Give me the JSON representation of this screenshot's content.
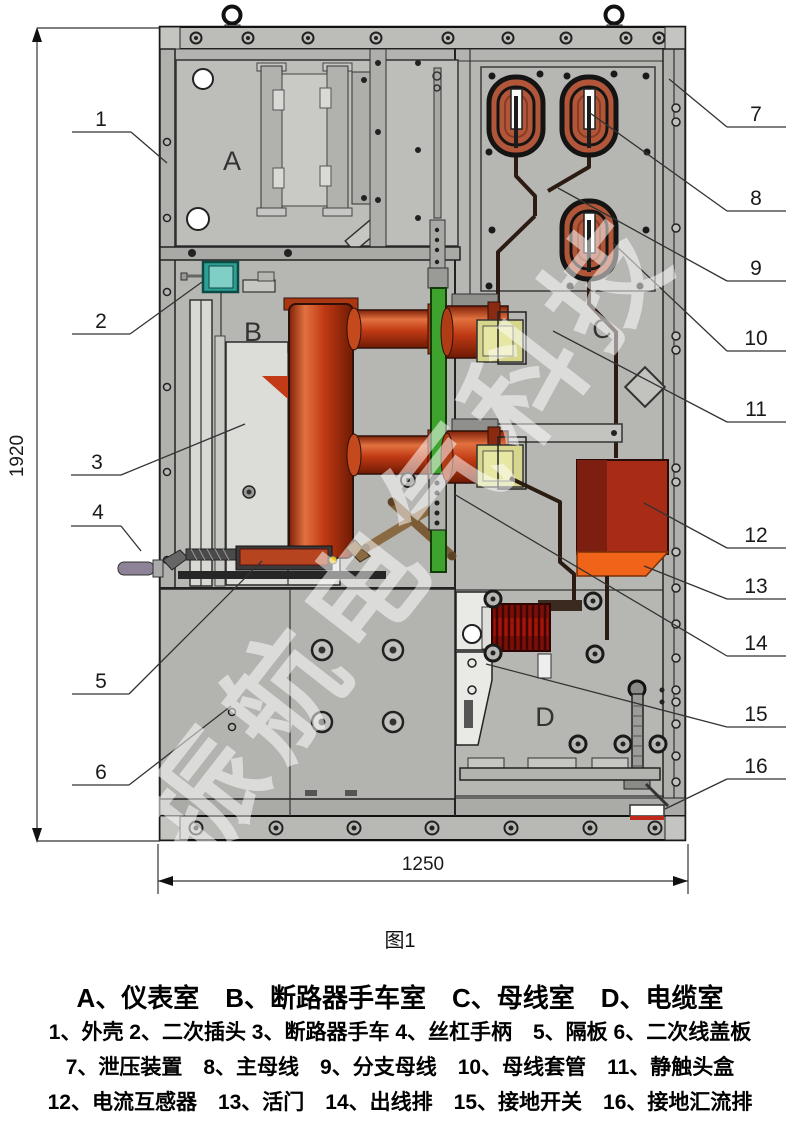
{
  "figure": {
    "caption": "图1",
    "height_dim": "1920",
    "width_dim": "1250"
  },
  "compartment_letters": {
    "a": "A",
    "b": "B",
    "c": "C",
    "d": "D"
  },
  "callouts": {
    "left": [
      {
        "n": "1"
      },
      {
        "n": "2"
      },
      {
        "n": "3"
      },
      {
        "n": "4"
      },
      {
        "n": "5"
      },
      {
        "n": "6"
      }
    ],
    "right": [
      {
        "n": "7"
      },
      {
        "n": "8"
      },
      {
        "n": "9"
      },
      {
        "n": "10"
      },
      {
        "n": "11"
      },
      {
        "n": "12"
      },
      {
        "n": "13"
      },
      {
        "n": "14"
      },
      {
        "n": "15"
      },
      {
        "n": "16"
      }
    ]
  },
  "watermark": {
    "text": "振航电气科技"
  },
  "legend": {
    "compartments": "A、仪表室　B、断路器手车室　C、母线室　D、电缆室",
    "row1": "1、外壳 2、二次插头 3、断路器手车 4、丝杠手柄　5、隔板 6、二次线盖板",
    "row2": "7、泄压装置　8、主母线　9、分支母线　10、母线套管　11、静触头盒",
    "row3": "12、电流互感器　13、活门　14、出线排　15、接地开关　16、接地汇流排"
  },
  "colors": {
    "cabinet_gray": "#b6b6b2",
    "bushing_red": "#b2563a",
    "pole_orange": "#c03a14",
    "green_shutter_panel": "#3da32e",
    "teal_secondary_plug": "#2f9f93",
    "ct_body_red": "#a82c15",
    "shutter_flap_orange": "#ef6418",
    "cable_termination_red": "#7c0f08",
    "contact_box_yellow": "#d6d78c",
    "earth_bar_red": "#c0281a"
  }
}
